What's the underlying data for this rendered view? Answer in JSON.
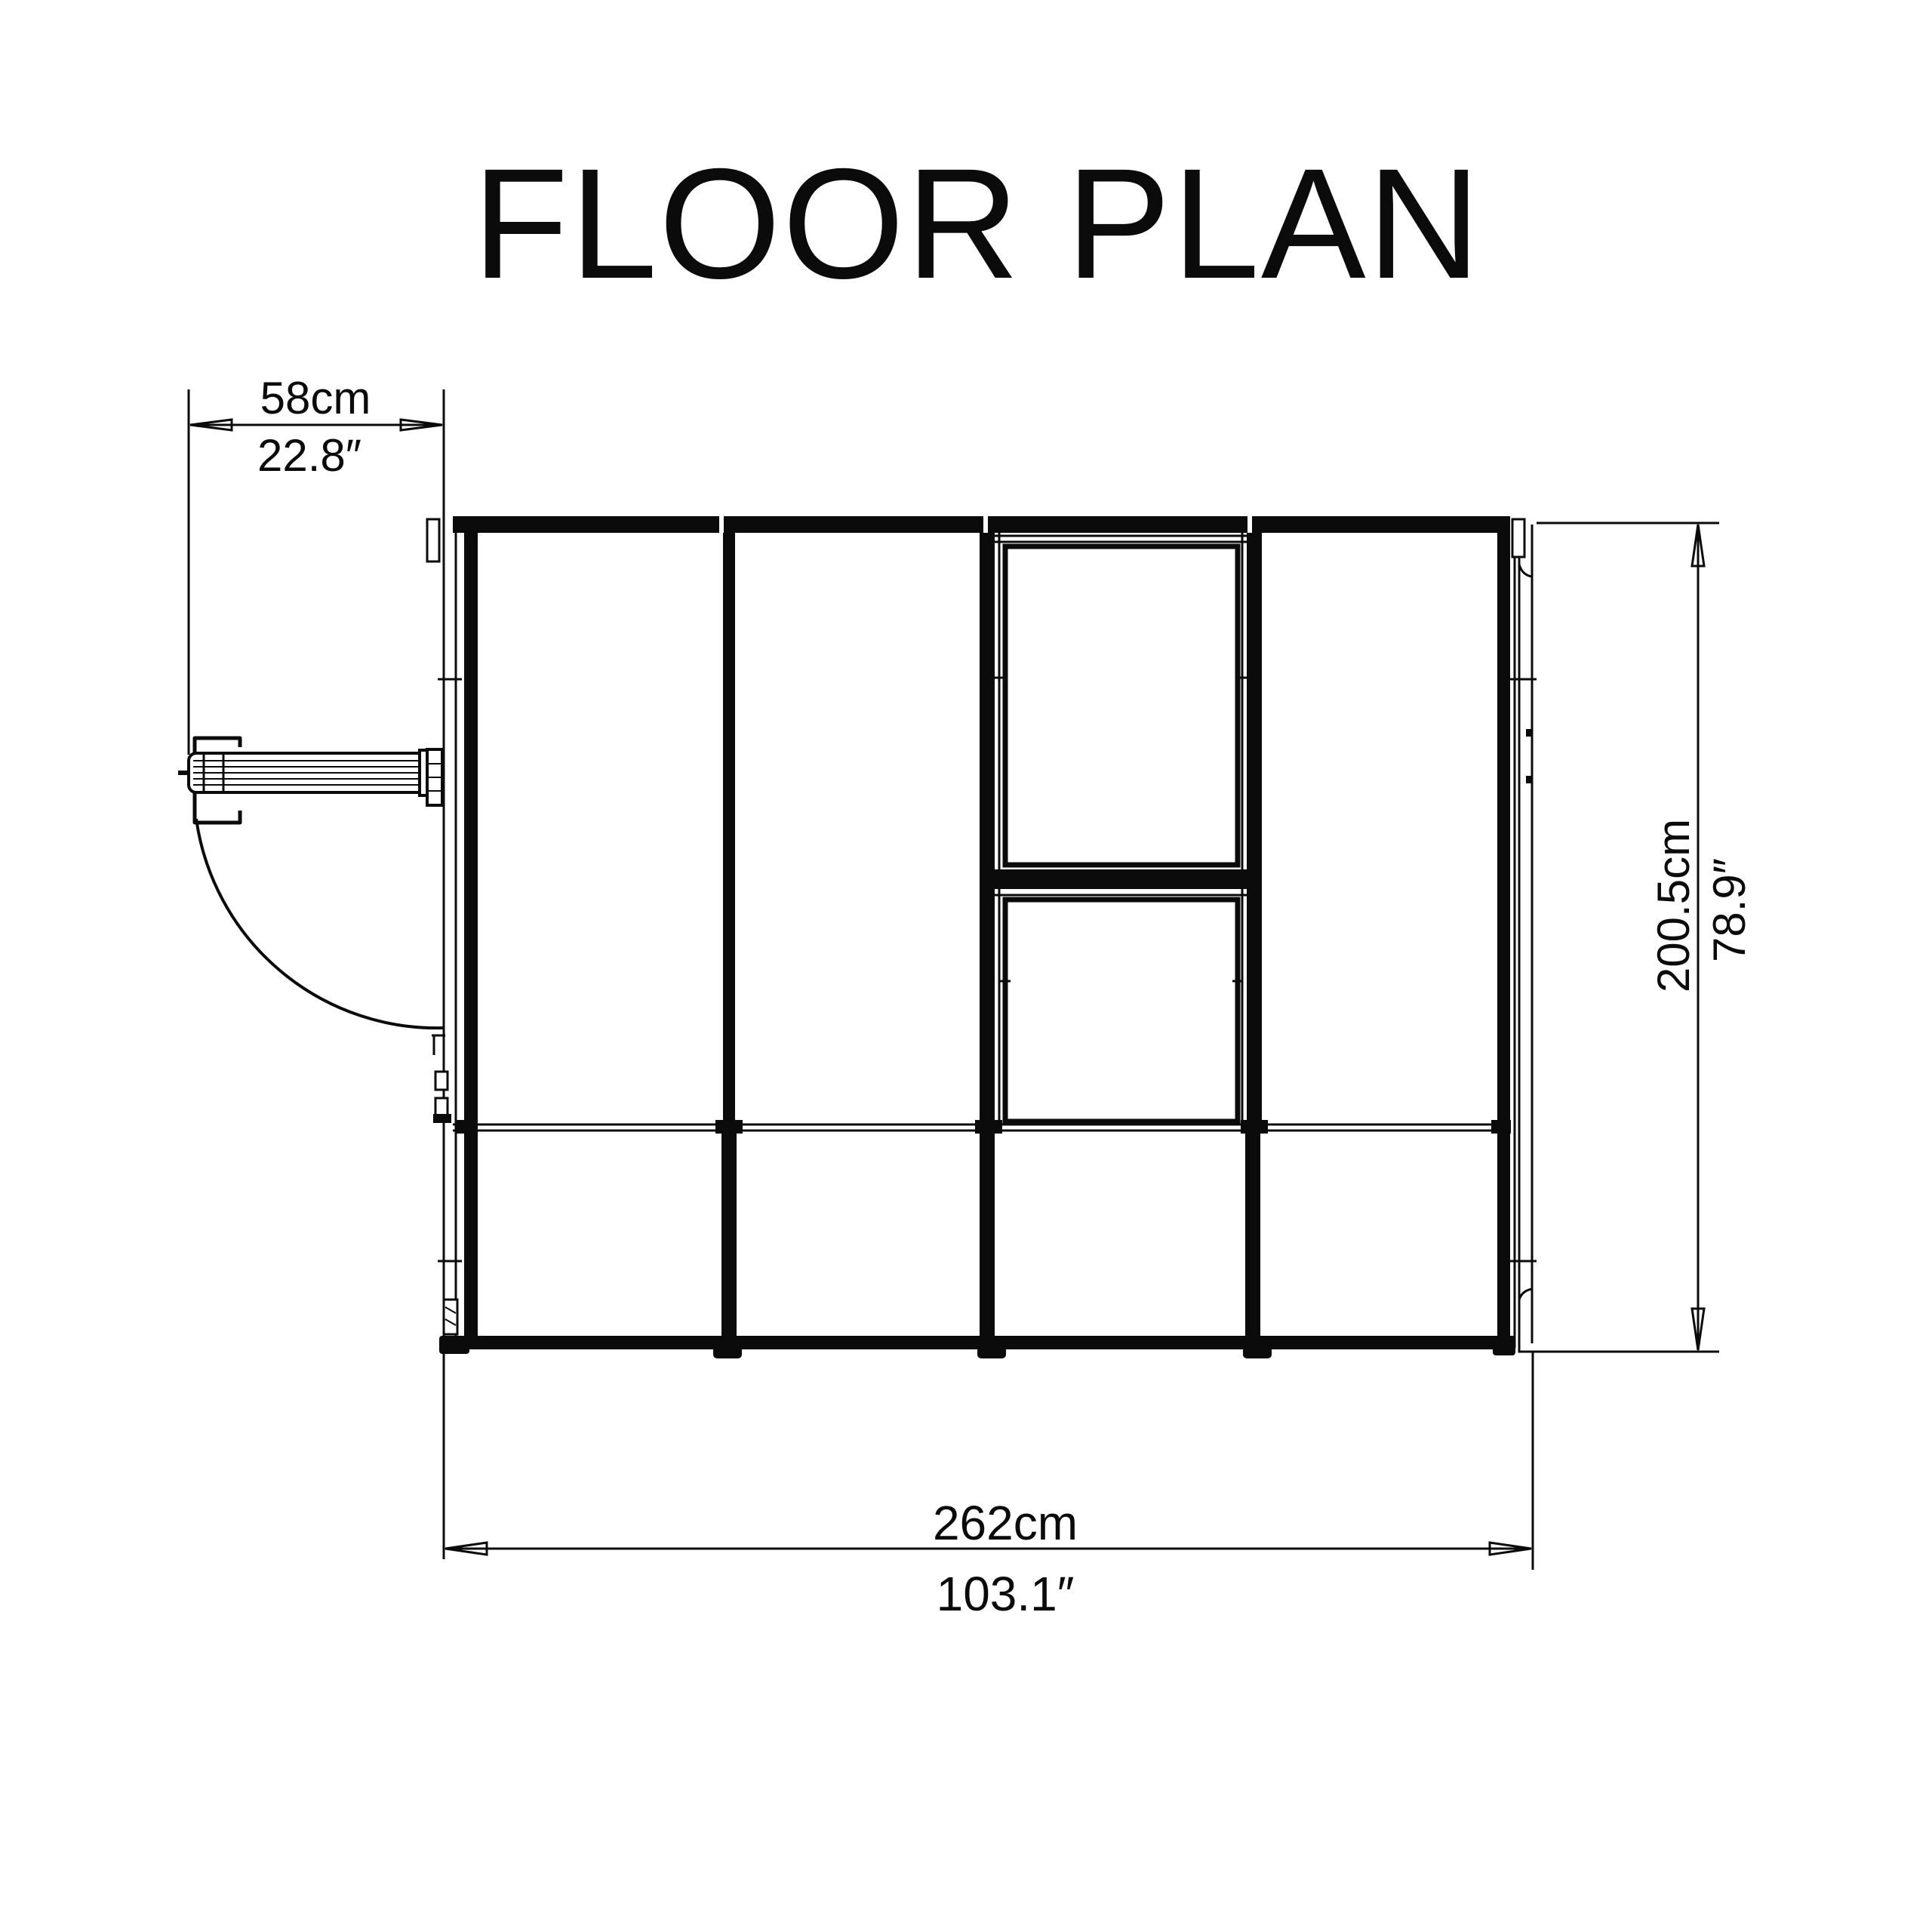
{
  "title": "FLOOR PLAN",
  "dimensions": {
    "door_width": {
      "metric": "58cm",
      "imperial": "22.8″"
    },
    "overall_width": {
      "metric": "262cm",
      "imperial": "103.1″"
    },
    "overall_depth": {
      "metric": "200.5cm",
      "imperial": "78.9″"
    }
  },
  "colors": {
    "line": "#0b0b0b",
    "background": "#ffffff"
  }
}
